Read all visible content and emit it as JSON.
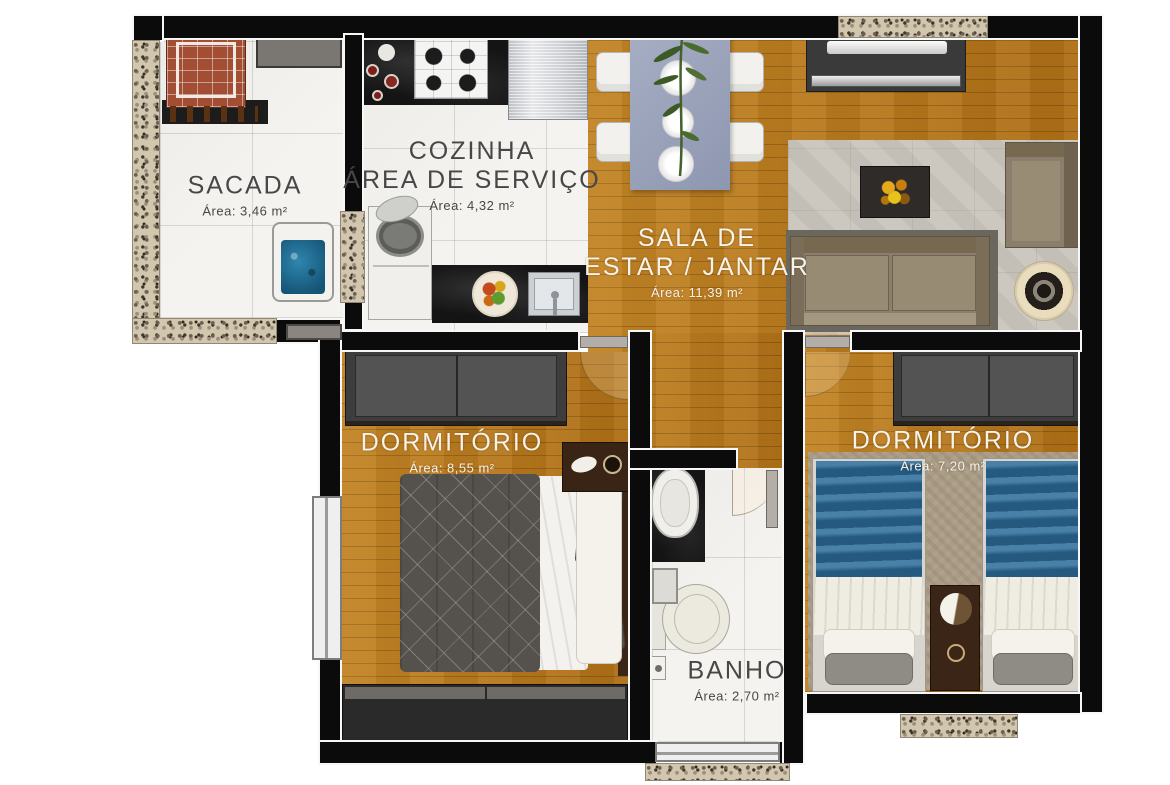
{
  "rooms": {
    "sacada": {
      "name": "SACADA",
      "area": "Área: 3,46 m²"
    },
    "cozinha": {
      "line1": "COZINHA",
      "line2": "ÁREA DE SERVIÇO",
      "area": "Área: 4,32 m²"
    },
    "sala": {
      "line1": "SALA DE",
      "line2": "ESTAR / JANTAR",
      "area": "Área: 11,39 m²"
    },
    "dormitorio1": {
      "name": "DORMITÓRIO",
      "area": "Área: 8,55 m²"
    },
    "dormitorio2": {
      "name": "DORMITÓRIO",
      "area": "Área: 7,20 m²"
    },
    "banho": {
      "name": "BANHO",
      "area": "Área: 2,70 m²"
    }
  },
  "colors": {
    "wall": "#0b0b0b",
    "wood_floor": "#b8791b",
    "tile_floor": "#f5f3f0",
    "granite_sill": "#d2c6af",
    "counter_dark": "#141414",
    "label_dark": "#474747",
    "label_light": "#f6f3ea",
    "sofa_taupe": "#8b7e6c",
    "duvet_blue": "#2d6d9b",
    "duvet_gray": "#55514c",
    "dining_table": "#9aa3ba",
    "brick_grill": "#a24e35"
  }
}
